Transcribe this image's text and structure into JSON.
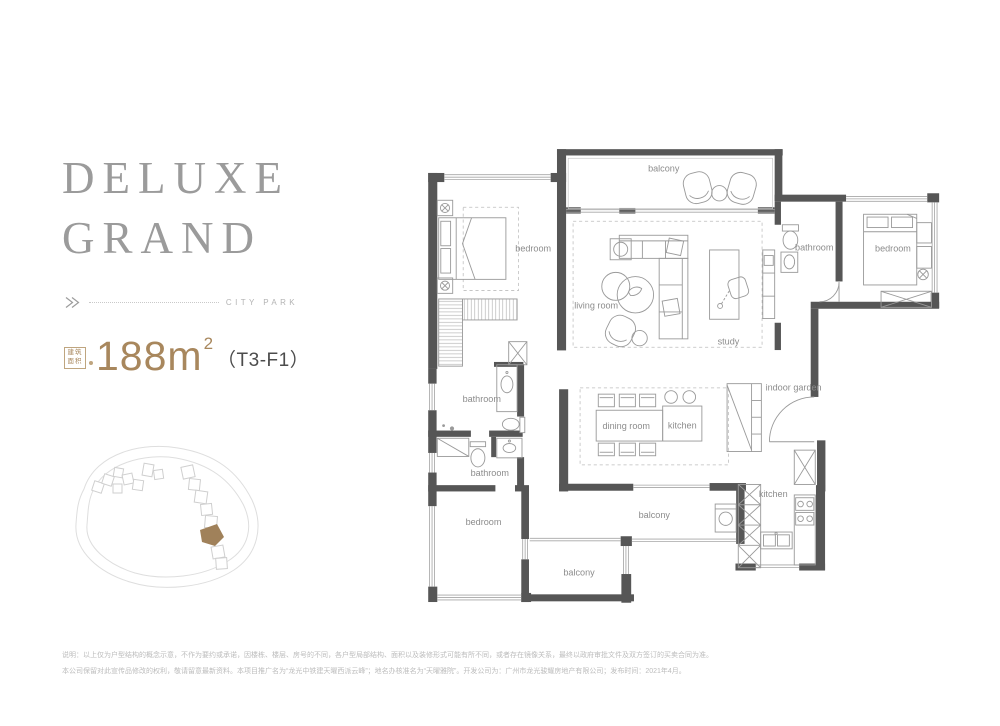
{
  "header": {
    "title_line1": "DELUXE",
    "title_line2": "GRAND",
    "tagline": "CITY PARK"
  },
  "area": {
    "label_cn_line1": "建筑",
    "label_cn_line2": "面积",
    "value": "188",
    "unit": "m",
    "superscript": "2",
    "unit_code": "（T3-F1）"
  },
  "floorplan": {
    "rooms": {
      "balcony_top": "balcony",
      "bedroom_top_left": "bedroom",
      "living_room": "living room",
      "study": "study",
      "bathroom_right": "bathroom",
      "bedroom_right": "bedroom",
      "bathroom_mid_upper": "bathroom",
      "bathroom_mid_lower": "bathroom",
      "dining_room": "dining room",
      "kitchen_island": "kitchen",
      "indoor_garden": "indoor garden",
      "bedroom_bottom_left": "bedroom",
      "balcony_mid": "balcony",
      "balcony_bottom": "balcony",
      "kitchen": "kitchen"
    }
  },
  "disclaimer": {
    "line1": "说明：以上仅为户型结构的概念示意，不作为要约或承诺，因楼栋、楼层、房号的不同，各户型局部结构、面积以及装修形式可能有所不同，或者存在镜像关系，最终以政府审批文件及双方签订的买卖合同为准。",
    "line2": "本公司保留对此宣传品修改的权利，敬请留意最新资料。本项目推广名为“龙光中铁建天曜西派云峰”；地名办核准名为“天曜雅院”。开发公司为：广州市龙光骏耀房地产有限公司；发布时间：2021年4月。"
  },
  "colors": {
    "accent_gold": "#a8875d",
    "title_gray": "#9b9b9b",
    "wall_dark": "#565656",
    "room_label": "#8c8c8c"
  }
}
